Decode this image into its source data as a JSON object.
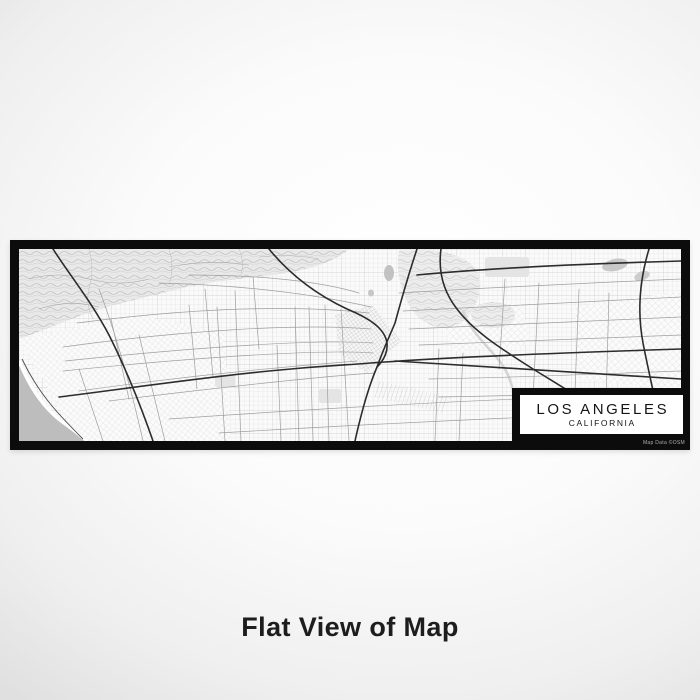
{
  "page": {
    "title": "Flat View of Map"
  },
  "map": {
    "label": {
      "city": "LOS ANGELES",
      "state": "CALIFORNIA"
    },
    "attribution": "Map Data ©OSM",
    "features": {
      "ocean": "Pacific Ocean / Santa Monica Bay",
      "mountains": "Santa Monica Mountains / Hollywood Hills",
      "downtown": "Downtown Los Angeles street grid",
      "style": "grayscale flat street map"
    },
    "colors": {
      "frame": "#0c0c0c",
      "land": "#fafafa",
      "ocean": "#bdbdbd",
      "beach": "#ffffff",
      "freeway": "#2c2c2c",
      "arterial": "#9f9f9f",
      "label_bg": "#ffffff",
      "label_text": "#151515",
      "attribution_text": "#b0b0b0",
      "title_text": "#1d1d1d"
    }
  }
}
